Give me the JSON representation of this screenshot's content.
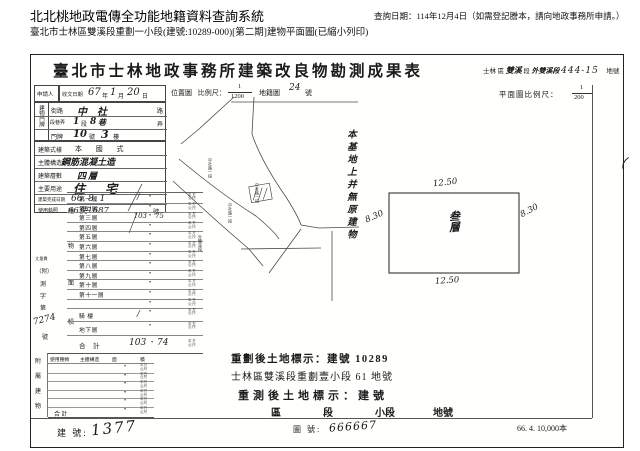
{
  "header": {
    "system_title": "北北桃地政電傳全功能地籍資料查詢系統",
    "query_date": "查詢日期：114年12月4日（如需登記謄本，請向地政事務所申請。）",
    "subtitle": "臺北市士林區雙溪段重劃一小段(建號:10289-000)[第二期]建物平面圖(已縮小列印)"
  },
  "form": {
    "title": "臺北市士林地政事務所建築改良物勘測成果表",
    "title_right": {
      "district": "士林",
      "district_suffix": "區",
      "section_hw": "雙溪",
      "section_suffix": "段",
      "subsection_hw": "外雙溪段",
      "lot_hw": "444-15",
      "lot_suffix": "地號"
    },
    "applicant_label": "申請人",
    "received": {
      "label": "收文日期",
      "year": "67",
      "y": "年",
      "month": "1",
      "m": "月",
      "day": "20",
      "d": "日"
    },
    "location_map": {
      "label": "位置圖",
      "scale_label": "比例尺：",
      "num": "1",
      "den": "1200",
      "cadastral": "地籍圖",
      "sheet_hw": "24",
      "sheet_suffix": "號",
      "road_labels": [
        "中社路一段",
        "中社路一段",
        "中社路一段",
        "外雙溪段"
      ]
    },
    "plan": {
      "scale_label": "平面圖比例尺：",
      "num": "1",
      "den": "200",
      "dim_top": "12.50",
      "dim_bottom": "12.50",
      "dim_left": "8.30",
      "dim_right": "8.30",
      "center_label_1": "叁",
      "center_label_2": "層",
      "margin_mark": "（"
    },
    "site_note": "本基地上并無原建物",
    "door_plate": {
      "label": "建物門牌",
      "street": {
        "label": "街路",
        "hw": "中社",
        "suffix": "路"
      },
      "lane": {
        "label": "段巷弄",
        "hw1": "1",
        "t1": "段",
        "hw2": "8",
        "t2": "巷",
        "suffix": "弄"
      },
      "number": {
        "label": "門牌",
        "hw1": "10",
        "t1": "號",
        "hw2": "3",
        "t2": "樓"
      }
    },
    "attrs": [
      {
        "label": "建築式樣",
        "value": "本 國 式"
      },
      {
        "label": "主體構造",
        "value": "鋼筋混凝土造"
      },
      {
        "label": "建築層數",
        "value": "四層"
      },
      {
        "label": "主要用途",
        "value": "住 宅"
      },
      {
        "label": "建築完成日期",
        "value": "66. 8. 1"
      },
      {
        "label": "使用執照",
        "value": "66使1687",
        "suffix": "號"
      }
    ],
    "floor_table": {
      "side_label": [
        "建",
        "物",
        "面",
        "積"
      ],
      "unit1": "平方",
      "unit2": "公尺",
      "rows": [
        {
          "label": "第一層",
          "v1": "",
          "v2": "",
          "mark": "/"
        },
        {
          "label": "第二層",
          "v1": "",
          "v2": "",
          "mark": ""
        },
        {
          "label": "第三層",
          "v1": "103",
          "v2": "75",
          "mark": ""
        },
        {
          "label": "第四層",
          "v1": "",
          "v2": "",
          "mark": ""
        },
        {
          "label": "第五層",
          "v1": "",
          "v2": "",
          "mark": ""
        },
        {
          "label": "第六層",
          "v1": "",
          "v2": "",
          "mark": ""
        },
        {
          "label": "第七層",
          "v1": "",
          "v2": "",
          "mark": ""
        },
        {
          "label": "第八層",
          "v1": "",
          "v2": "",
          "mark": ""
        },
        {
          "label": "第九層",
          "v1": "",
          "v2": "",
          "mark": ""
        },
        {
          "label": "第十層",
          "v1": "",
          "v2": "",
          "mark": ""
        },
        {
          "label": "第十一層",
          "v1": "",
          "v2": "",
          "mark": ""
        },
        {
          "label": "",
          "v1": "",
          "v2": "",
          "mark": ""
        }
      ],
      "qilou_label": "騎 樓",
      "qilou_mark": "/",
      "basement_label": "地下層",
      "total_label": "合　計",
      "total_v1": "103",
      "total_v2": "74"
    },
    "file_no": {
      "small_label": "丈量費",
      "p1": "（附）",
      "p2": "測",
      "p3": "字",
      "p4": "第",
      "hw": "7274",
      "suffix": "號"
    },
    "attached": {
      "side_label": [
        "附",
        "屬",
        "建",
        "物"
      ],
      "headers": [
        "使用種類",
        "主體構造",
        "面",
        "積"
      ],
      "empty_rows": 5,
      "total_label": "合 計",
      "unit1": "平方",
      "unit2": "公尺"
    },
    "land_marks": {
      "line1": "重劃後土地標示：建號 10289",
      "line2": "士林區雙溪段重劃壹小段 61 地號",
      "line3": "重測後土地標示：建號",
      "line4_a": "區",
      "line4_b": "段",
      "line4_c": "小段",
      "line4_d": "地號"
    },
    "footer": {
      "building_label": "建 號:",
      "building_hw": "1377",
      "map_label": "圖 號:",
      "map_hw": "666667",
      "print_info": "66. 4. 10,000本"
    }
  }
}
